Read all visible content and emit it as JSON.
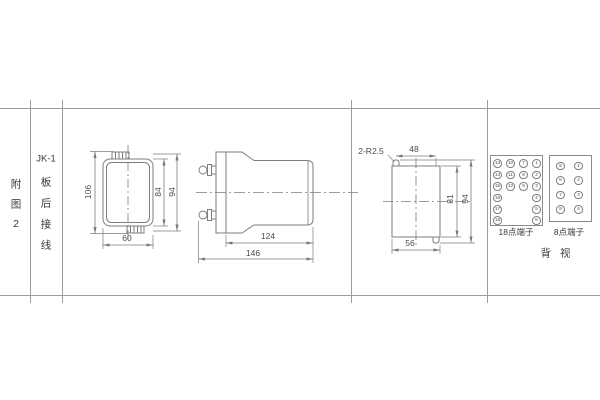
{
  "table": {
    "col1": [
      "附",
      "图",
      "2"
    ],
    "col2_title": "JK-1",
    "col2": [
      "板",
      "后",
      "接",
      "线"
    ]
  },
  "views": {
    "front": {
      "dims": {
        "height_overall": "106",
        "height_inner": "84",
        "height_mid": "94",
        "width": "60"
      }
    },
    "side": {
      "dims": {
        "body_length": "124",
        "overall_length": "146"
      }
    },
    "cutout": {
      "dims": {
        "notch_radius": "2-R2.5",
        "top_width": "48",
        "inner_height": "81",
        "overall_height": "94",
        "bottom_width": "56"
      }
    }
  },
  "terminals": {
    "p18": {
      "label": "18点端子",
      "cells": [
        {
          "n": "13",
          "c": 0,
          "r": 0
        },
        {
          "n": "10",
          "c": 1,
          "r": 0
        },
        {
          "n": "7",
          "c": 2,
          "r": 0
        },
        {
          "n": "1",
          "c": 3,
          "r": 0
        },
        {
          "n": "14",
          "c": 0,
          "r": 1
        },
        {
          "n": "11",
          "c": 1,
          "r": 1
        },
        {
          "n": "8",
          "c": 2,
          "r": 1
        },
        {
          "n": "2",
          "c": 3,
          "r": 1
        },
        {
          "n": "15",
          "c": 0,
          "r": 2
        },
        {
          "n": "12",
          "c": 1,
          "r": 2
        },
        {
          "n": "9",
          "c": 2,
          "r": 2
        },
        {
          "n": "3",
          "c": 3,
          "r": 2
        },
        {
          "n": "16",
          "c": 0,
          "r": 3
        },
        {
          "n": "4",
          "c": 3,
          "r": 3
        },
        {
          "n": "17",
          "c": 0,
          "r": 4
        },
        {
          "n": "5",
          "c": 3,
          "r": 4
        },
        {
          "n": "18",
          "c": 0,
          "r": 5
        },
        {
          "n": "6",
          "c": 3,
          "r": 5
        }
      ]
    },
    "p8": {
      "label": "8点端子",
      "cells": [
        {
          "n": "5",
          "c": 0,
          "r": 0
        },
        {
          "n": "1",
          "c": 1,
          "r": 0
        },
        {
          "n": "6",
          "c": 0,
          "r": 1
        },
        {
          "n": "2",
          "c": 1,
          "r": 1
        },
        {
          "n": "7",
          "c": 0,
          "r": 2
        },
        {
          "n": "3",
          "c": 1,
          "r": 2
        },
        {
          "n": "8",
          "c": 0,
          "r": 3
        },
        {
          "n": "4",
          "c": 1,
          "r": 3
        }
      ]
    },
    "back_view_label": "背视"
  },
  "colors": {
    "line": "#8a8a8a",
    "text": "#4a4a4a"
  }
}
